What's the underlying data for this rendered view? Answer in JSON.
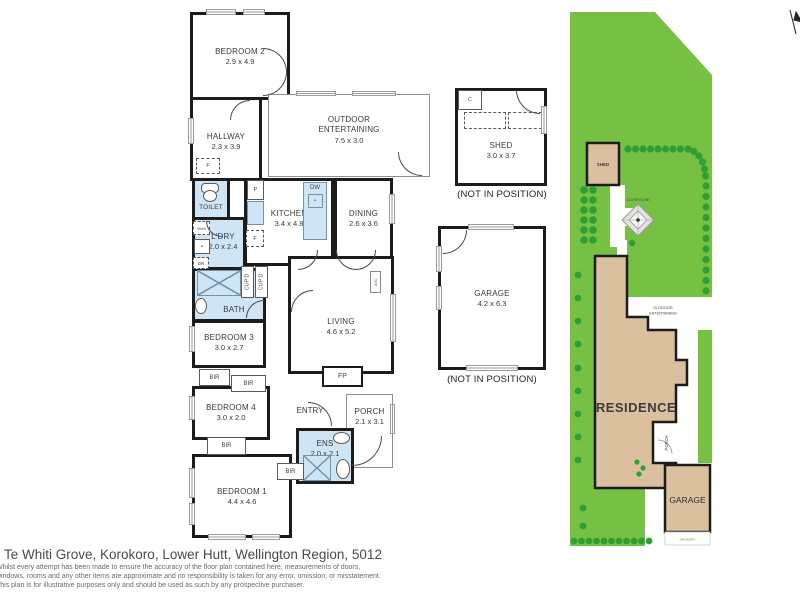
{
  "floor_plan": {
    "rooms": {
      "bedroom2": {
        "name": "BEDROOM 2",
        "dims": "2.9 x 4.9"
      },
      "hallway": {
        "name": "HALLWAY",
        "dims": "2.3 x 3.9"
      },
      "outdoor": {
        "name": "OUTDOOR ENTERTAINING",
        "dims": "7.5 x 3.0"
      },
      "toilet": {
        "name": "TOILET"
      },
      "kitchen": {
        "name": "KITCHEN",
        "dims": "3.4 x 4.8"
      },
      "dining": {
        "name": "DINING",
        "dims": "2.6 x 3.6"
      },
      "laundry": {
        "name": "L'DRY",
        "dims": "2.0 x 2.4"
      },
      "bath": {
        "name": "BATH",
        "dims": "3.0 x 1.8"
      },
      "bedroom3": {
        "name": "BEDROOM 3",
        "dims": "3.0 x 2.7"
      },
      "living": {
        "name": "LIVING",
        "dims": "4.6 x 5.2"
      },
      "bedroom4": {
        "name": "BEDROOM 4",
        "dims": "3.0 x 2.0"
      },
      "entry": {
        "name": "ENTRY"
      },
      "porch": {
        "name": "PORCH",
        "dims": "2.1 x 3.1"
      },
      "ens": {
        "name": "ENS",
        "dims": "2.0 x 2.1"
      },
      "bedroom1": {
        "name": "BEDROOM 1",
        "dims": "4.4 x 4.6"
      },
      "shed": {
        "name": "SHED",
        "dims": "3.0 x 3.7",
        "caption": "(NOT IN POSITION)"
      },
      "garage": {
        "name": "GARAGE",
        "dims": "4.2 x 6.3",
        "caption": "(NOT IN POSITION)"
      }
    },
    "fixtures": {
      "freezer_hall": "F",
      "pantry": "P",
      "dishwasher": "DW",
      "fridge": "F",
      "washing_machine": "W/M",
      "dryer": "DR",
      "cupboard1": "CUP'D",
      "cupboard2": "CUP'D",
      "bir1": "BIR",
      "bir2": "BIR",
      "bir3": "BIR",
      "bir4": "BIR",
      "fireplace": "FP",
      "aircon": "A/C",
      "shed_cupboard": "C"
    }
  },
  "site_plan": {
    "labels": {
      "residence": "RESIDENCE",
      "shed": "SHED",
      "garage": "GARAGE",
      "outdoor_line1": "OUTDOOR",
      "outdoor_line2": "ENTERTAINING",
      "porch": "PORCH",
      "clothes_line": "CLOTHES LINE",
      "driveway": "DRIVEWAY"
    },
    "colors": {
      "lawn": "#76c043",
      "tree": "#2f9e35",
      "building": "#dbc0a0",
      "wall": "#1c1c1c",
      "wet_area": "#cfe4f4"
    }
  },
  "footer": {
    "address": "5 Te Whiti Grove, Korokoro, Lower Hutt, Wellington Region, 5012",
    "disclaimer1": "Whilst every attempt has been made to ensure the accuracy of the floor plan contained here, measurements of doors,",
    "disclaimer2": "windows, rooms and any other items are approximate and no responsibility is taken for any error, omission, or misstatement.",
    "disclaimer3": "This plan is for illustrative purposes only and should be used as such by any prospective purchaser."
  }
}
